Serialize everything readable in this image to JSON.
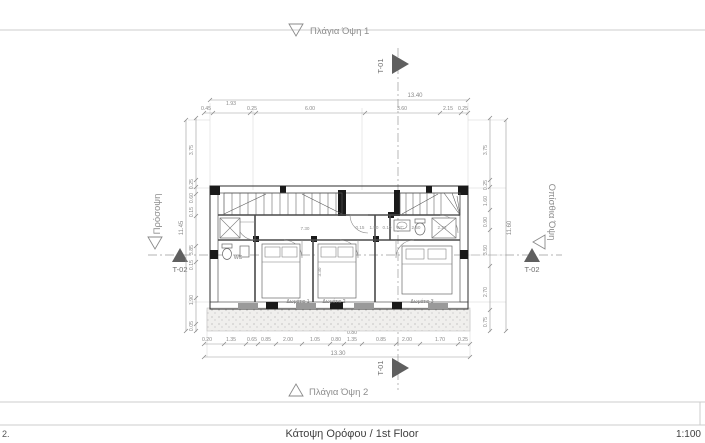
{
  "footer": {
    "left_note": "2.",
    "title": "Κάτοψη Ορόφου / 1st Floor",
    "scale": "1:100"
  },
  "views": {
    "top": "Πλάγια Όψη 1",
    "bottom": "Πλάγια Όψη 2",
    "left": "Πρόσοψη",
    "right": "Οπίσθια Όψη"
  },
  "sections": {
    "t01": "T-01",
    "t02": "T-02"
  },
  "rooms": {
    "bedroom1": "Δωμάτιο 1",
    "bedroom2": "Δωμάτιο 2",
    "bedroom3": "Δωμάτιο 3",
    "wc_left": "WC",
    "wc_right": "WC"
  },
  "dims": {
    "top_overall": "13.40",
    "top": [
      "0.45",
      "1.93",
      "0.25",
      "6.00",
      "3.60",
      "2.15",
      "0.25"
    ],
    "bottom": [
      "0.20",
      "1.35",
      "0.65",
      "0.85",
      "2.00",
      "1.05",
      "0.80",
      "1.35",
      "0.85",
      "2.00",
      "1.70",
      "0.25"
    ],
    "bottom_small": "0.80",
    "bottom_overall": "13.30",
    "left": [
      "3.75",
      "0.25",
      "0.60",
      "0.15",
      "3.85",
      "0.15",
      "1.90",
      "0.05"
    ],
    "left_overall": "11.45",
    "right": [
      "3.75",
      "0.25",
      "1.60",
      "0.90",
      "3.50",
      "2.70",
      "0.75"
    ],
    "right_overall": "11.60",
    "interior": [
      "7.30",
      "0.15",
      "1.50",
      "0.10",
      "2.50",
      "2.23",
      "3.30"
    ]
  },
  "colors": {
    "linework": "#4a4a4a",
    "dimension": "#8f8f8f",
    "marker": "#5f5f5f",
    "sheet_line": "#cccccc",
    "column_fill": "#1a1a1a"
  }
}
